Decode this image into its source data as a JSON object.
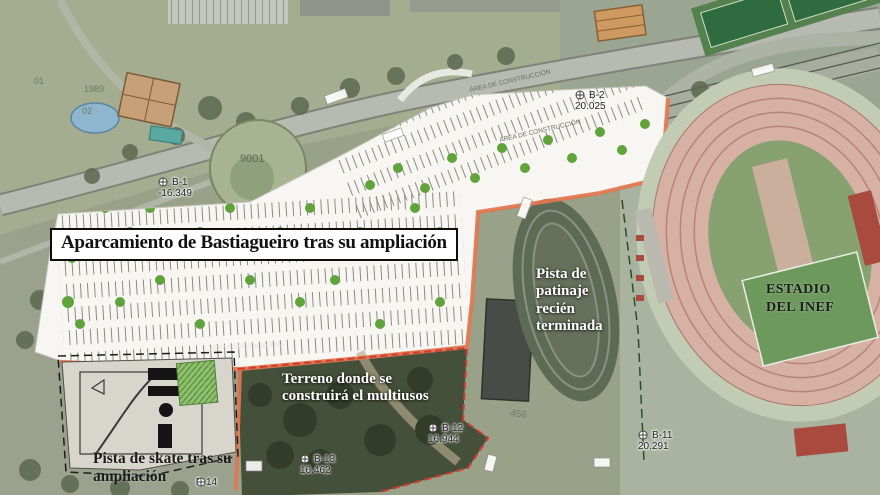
{
  "title": {
    "text": "Aparcamiento de Bastiagueiro tras su ampliación"
  },
  "labels": {
    "skating_rink": "Pista de patinaje recién terminada",
    "stadium": "ESTADIO\nDEL INEF",
    "terrain": "Terreno donde se construirá el multiusos",
    "skate_park": "Pista de skate tras su ampliación",
    "area_note": "ÁREA ROTACIÓN MÁXIMA",
    "road_note": "ÁREA DE CONSTRUCCIÓN"
  },
  "markers": [
    {
      "id": "B-1",
      "value": "-16.349"
    },
    {
      "id": "B-2",
      "value": "20.025"
    },
    {
      "id": "B-11",
      "value": "20.291"
    },
    {
      "id": "B-12",
      "value": "16.944"
    },
    {
      "id": "B-13",
      "value": "16.462"
    },
    {
      "id": "B-14",
      "value": ""
    }
  ],
  "cadastral": [
    "9001",
    "456",
    "1989",
    "01",
    "02"
  ],
  "colors": {
    "parking_surface": "#f7f6f2",
    "construction_boundary": "#e1764f",
    "terrain_boundary_dashed": "#d23b2f",
    "track_pink": "#d7b2a4",
    "field_green": "#87a171",
    "tree_green": "#61a33b",
    "label_white": "#ffffff",
    "label_black": "#1b1b1b"
  }
}
